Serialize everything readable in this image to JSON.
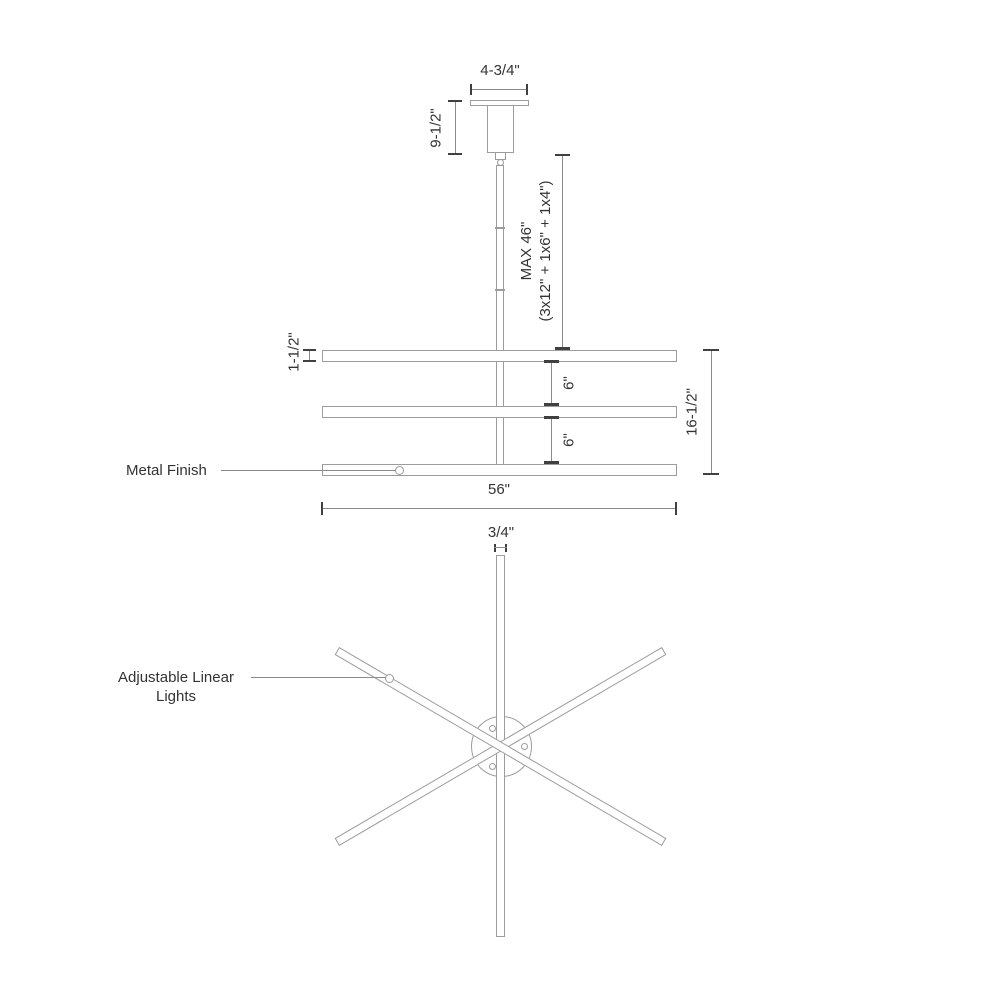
{
  "elevation": {
    "canopy_width": "4-3/4\"",
    "canopy_height": "9-1/2\"",
    "rod_max_line1": "MAX 46\"",
    "rod_max_line2": "(3x12\" + 1x6\" + 1x4\")",
    "bar_thickness": "1-1/2\"",
    "gap_upper": "6\"",
    "gap_lower": "6\"",
    "stack_height": "16-1/2\"",
    "fixture_width": "56\"",
    "finish_label": "Metal Finish"
  },
  "plan": {
    "bar_width": "3/4\"",
    "lights_label": "Adjustable Linear Lights"
  },
  "colors": {
    "object_line": "#9c9c9c",
    "dimension_line": "#8a8a8a",
    "tick": "#404040",
    "text": "#333333",
    "background": "#ffffff"
  }
}
